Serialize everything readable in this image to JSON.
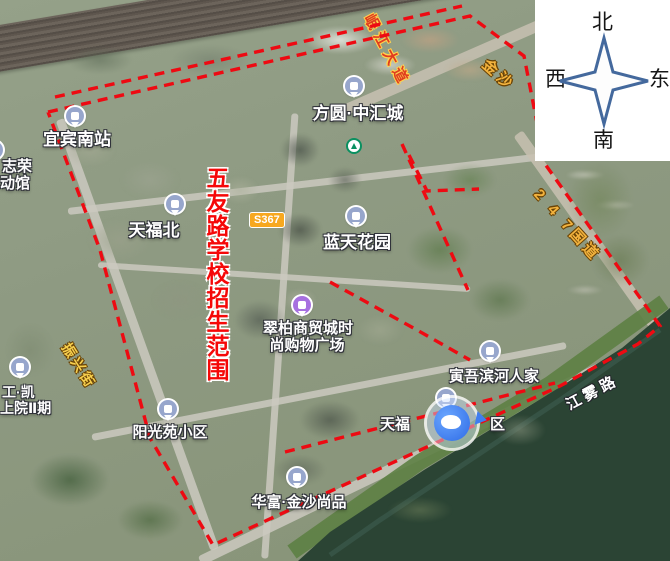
{
  "title": {
    "text": "五友路学校招生范围",
    "color": "#f50808"
  },
  "compass": {
    "north": "北",
    "south": "南",
    "west": "西",
    "east": "东"
  },
  "pois": {
    "station": {
      "name": "宜宾南站"
    },
    "partial_left_top": {
      "line1": "志荣",
      "line2": "动馆"
    },
    "fangyuan": {
      "name": "方圆·中汇城"
    },
    "tianfubei": {
      "name": "天福北"
    },
    "road_badge": {
      "text": "S367"
    },
    "lantian": {
      "name": "蓝天花园"
    },
    "cuibai": {
      "line1": "翠柏商贸城时",
      "line2": "尚购物广场"
    },
    "yinwu": {
      "name": "寅吾滨河人家"
    },
    "tianfu_xiaoqu": {
      "left": "天福",
      "right": "区"
    },
    "yangguang": {
      "name": "阳光苑小区"
    },
    "huafu": {
      "name": "华富·金沙尚品"
    },
    "partial_left_bottom": {
      "line1": "工·凯",
      "line2": "上院Ⅱ期"
    }
  },
  "roads": {
    "minjiang": "岷江大道",
    "jinsha": "金沙",
    "g247": "2 4 7国道",
    "zhenxing": "振兴街",
    "jiangwu": "江雾路"
  },
  "boundary": {
    "color": "#ee0a12",
    "main": [
      [
        48,
        112
      ],
      [
        470,
        16
      ],
      [
        524,
        56
      ],
      [
        545,
        164
      ],
      [
        660,
        326
      ],
      [
        638,
        344
      ],
      [
        560,
        386
      ],
      [
        213,
        545
      ],
      [
        150,
        438
      ],
      [
        100,
        250
      ],
      [
        48,
        112
      ]
    ],
    "extra": [
      [
        [
          55,
          97
        ],
        [
          462,
          6
        ]
      ],
      [
        [
          285,
          452
        ],
        [
          555,
          383
        ]
      ],
      [
        [
          409,
          155
        ],
        [
          427,
          191
        ],
        [
          479,
          189
        ]
      ],
      [
        [
          402,
          144
        ],
        [
          468,
          290
        ]
      ],
      [
        [
          330,
          282
        ],
        [
          417,
          330
        ],
        [
          470,
          360
        ]
      ]
    ]
  }
}
